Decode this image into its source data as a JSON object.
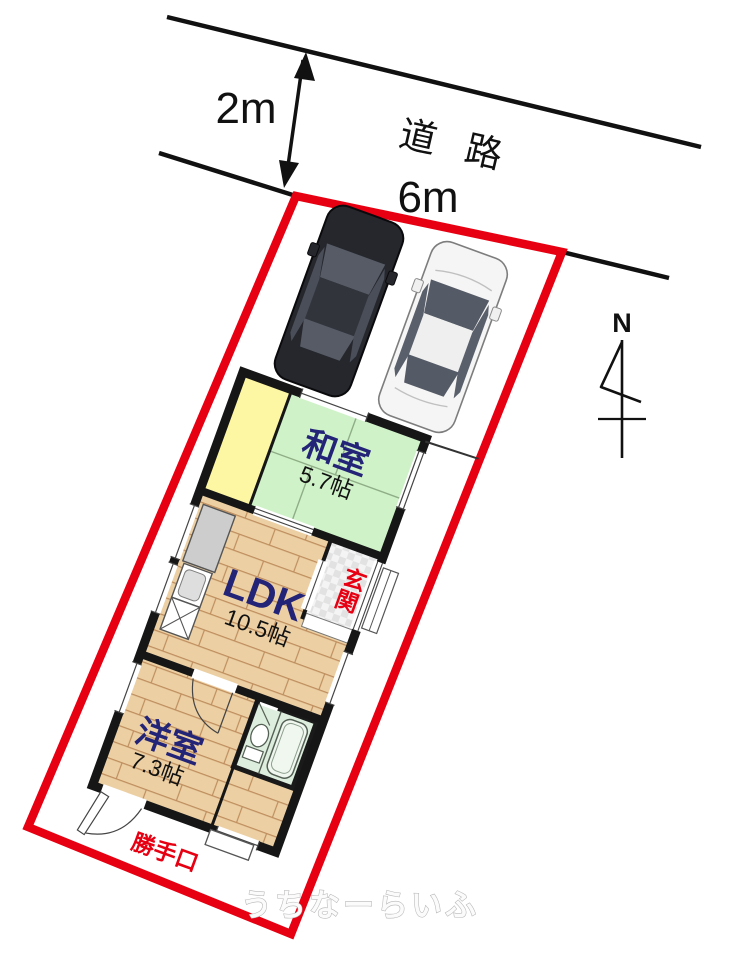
{
  "annotations": {
    "road_label": "道 路",
    "road_width": "2m",
    "frontage_width": "6m",
    "compass_north": "N",
    "watermark": "うちなーらいふ"
  },
  "rooms": {
    "washitsu": {
      "label": "和室",
      "area": "5.7帖"
    },
    "ldk": {
      "label": "LDK",
      "area": "10.5帖"
    },
    "youshitsu": {
      "label": "洋室",
      "area": "7.3帖"
    },
    "genkan": {
      "label": "玄関"
    },
    "katteguchi": {
      "label": "勝手口"
    }
  },
  "colors": {
    "boundary": "#e60012",
    "tatami": "#cff2c8",
    "closet_yellow": "#fdf6a3",
    "wood": "#ecd0a4",
    "bath": "#ddeede",
    "room_label": "#232377",
    "red_label": "#e60012"
  }
}
